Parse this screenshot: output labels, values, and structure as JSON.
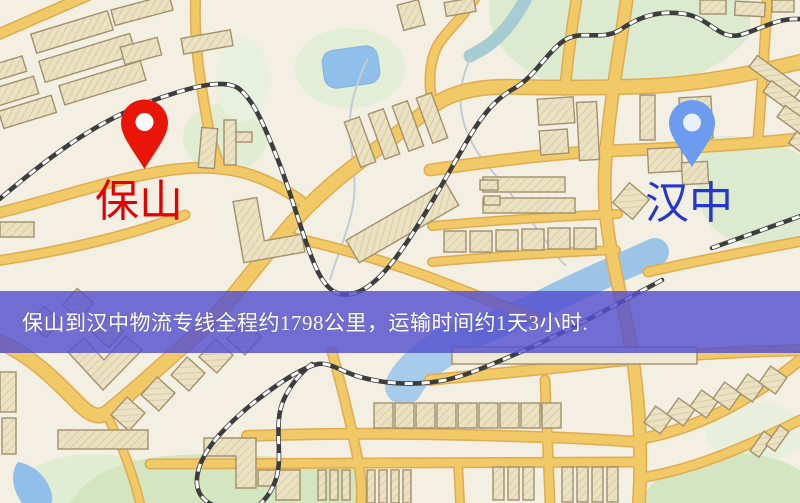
{
  "map": {
    "banner": {
      "text": "保山到汉中物流专线全程约1798公里，运输时间约1天3小时.",
      "background_color": "#5450ce",
      "text_color": "#ffffff"
    },
    "origin_marker": {
      "label": "保山",
      "pin_color": "#ee1407",
      "pin_hole_color": "#ffffff",
      "label_color": "#e60202"
    },
    "destination_marker": {
      "label": "汉中",
      "pin_color": "#6b9bf2",
      "pin_hole_color": "#e9f0fd",
      "label_color": "#2336d4"
    },
    "legend_colors": {
      "background": "#f4efe3",
      "road": "#f2c964",
      "road_casing": "#e0ac4e",
      "park": "#dcebcf",
      "water": "#93bfe6",
      "building": "#ebe2c3",
      "railway": "#3d3d3d"
    }
  }
}
